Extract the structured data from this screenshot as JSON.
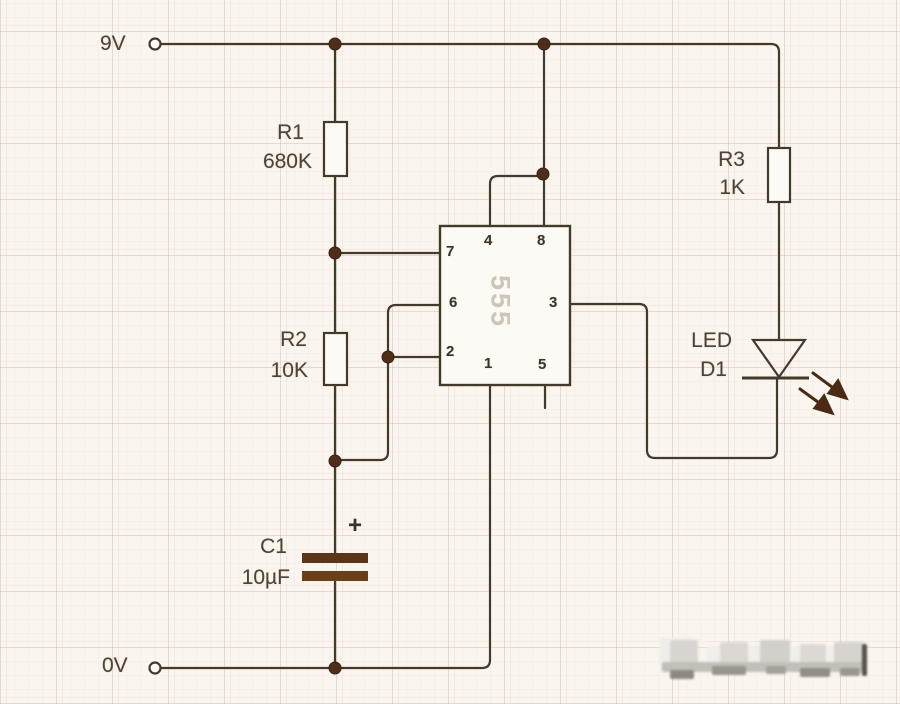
{
  "power": {
    "positive": "9V",
    "negative": "0V"
  },
  "ic": {
    "label": "555",
    "pins": {
      "p1": "1",
      "p2": "2",
      "p3": "3",
      "p4": "4",
      "p5": "5",
      "p6": "6",
      "p7": "7",
      "p8": "8"
    }
  },
  "resistors": {
    "r1": {
      "name": "R1",
      "value": "680K"
    },
    "r2": {
      "name": "R2",
      "value": "10K"
    },
    "r3": {
      "name": "R3",
      "value": "1K"
    }
  },
  "capacitor": {
    "name": "C1",
    "value": "10µF",
    "polarity_mark": "+"
  },
  "led": {
    "type_label": "LED",
    "designator": "D1"
  },
  "colors": {
    "background": "#faf5ee",
    "wire": "#433a2c",
    "junction_dot": "#4e2d1b",
    "capacitor_plate": "#63391a",
    "led_arrow": "#4a2a12",
    "ic_watermark_text": "#cdc5b7",
    "label_text": "#4d4437"
  }
}
